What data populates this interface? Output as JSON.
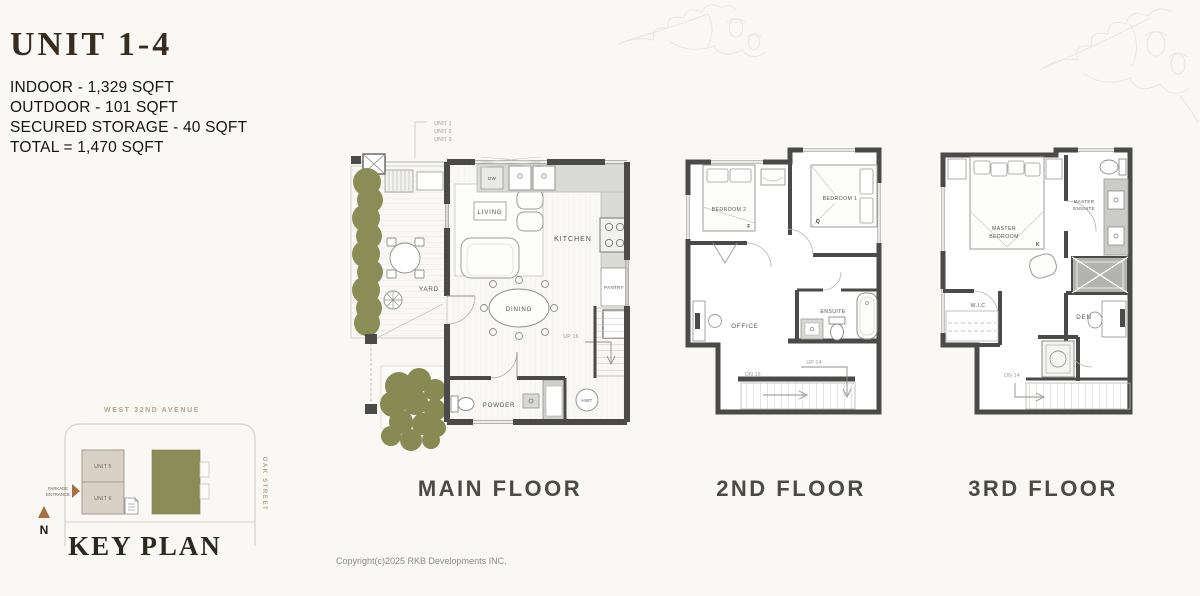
{
  "page": {
    "copyright": "Copyright(c)2025 RKB Developments INC."
  },
  "header": {
    "title": "UNIT 1-4",
    "stat_indoor": "INDOOR - 1,329 SQFT",
    "stat_outdoor": "OUTDOOR - 101 SQFT",
    "stat_storage": "SECURED STORAGE - 40 SQFT",
    "stat_total": "TOTAL = 1,470 SQFT"
  },
  "main_floor": {
    "label": "MAIN FLOOR",
    "callout_unit1": "UNIT 1",
    "callout_unit2": "UNIT 2",
    "callout_unit3": "UNIT 3",
    "living": "LIVING",
    "kitchen": "KITCHEN",
    "dining": "DINING",
    "yard": "YARD",
    "powder": "POWDER",
    "pantry": "PANTRY",
    "hwt": "HWT",
    "dw": "DW",
    "stairs_up": "UP 16"
  },
  "second_floor": {
    "label": "2ND FLOOR",
    "bedroom2": "BEDROOM 2",
    "bedroom1": "BEDROOM 1",
    "bed2_type": "F",
    "bed1_type": "Q",
    "office": "OFFICE",
    "ensuite": "ENSUITE",
    "stairs_up": "UP 14",
    "stairs_dn": "DN 16"
  },
  "third_floor": {
    "label": "3RD FLOOR",
    "master_line1": "MASTER",
    "master_line2": "BEDROOM",
    "ensuite_line1": "MASTER",
    "ensuite_line2": "ENSUITE",
    "bed_type": "K",
    "wic": "W.I.C",
    "den": "DEN",
    "stairs_dn": "DN 14"
  },
  "key_plan": {
    "title": "KEY PLAN",
    "street_top": "WEST 32ND AVENUE",
    "street_right": "OAK STREET",
    "unit5": "UNIT 5",
    "unit6": "UNIT 6",
    "parkade_line1": "PARKADE",
    "parkade_line2": "ENTRANCE",
    "north": "N"
  },
  "colors": {
    "wall": "#4a4a48",
    "accent_green": "#8b8d56",
    "taupe_block": "#d9d1c6",
    "street_text": "#b3a58f",
    "title_brown": "#372d1f"
  }
}
